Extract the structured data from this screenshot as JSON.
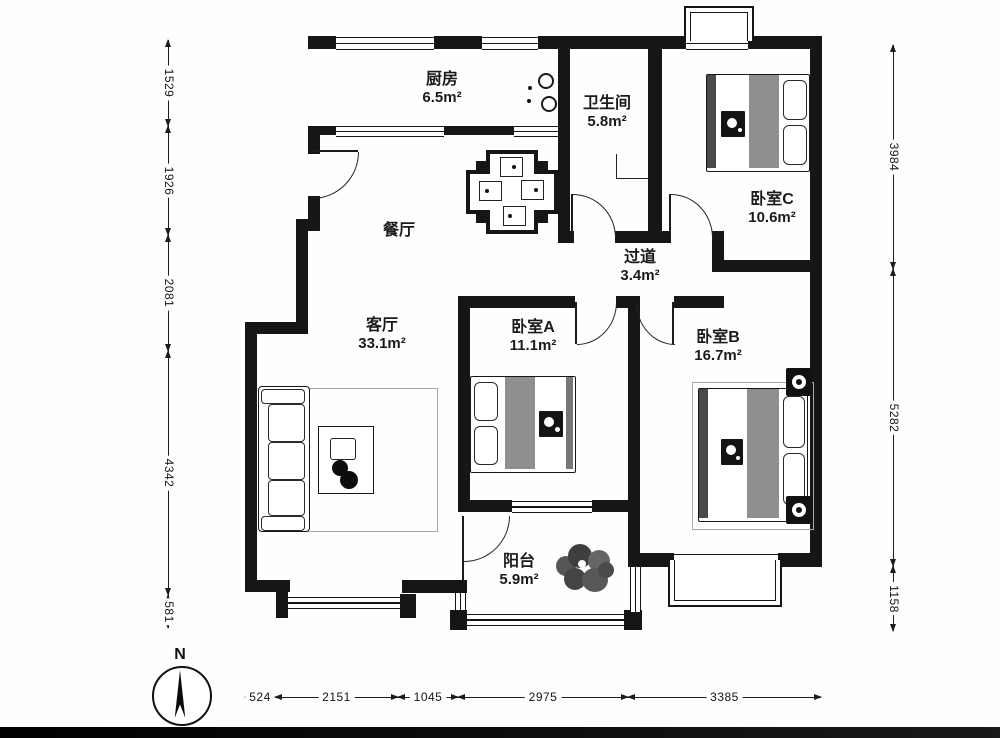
{
  "compass": {
    "north_label": "N"
  },
  "rooms": {
    "kitchen": {
      "name": "厨房",
      "area": "6.5m²"
    },
    "bathroom": {
      "name": "卫生间",
      "area": "5.8m²"
    },
    "bedroom_c": {
      "name": "卧室C",
      "area": "10.6m²"
    },
    "dining": {
      "name": "餐厅"
    },
    "hallway": {
      "name": "过道",
      "area": "3.4m²"
    },
    "living": {
      "name": "客厅",
      "area": "33.1m²"
    },
    "bedroom_a": {
      "name": "卧室A",
      "area": "11.1m²"
    },
    "bedroom_b": {
      "name": "卧室B",
      "area": "16.7m²"
    },
    "balcony": {
      "name": "阳台",
      "area": "5.9m²"
    }
  },
  "dimensions": {
    "left": [
      "1529",
      "1926",
      "2081",
      "4342",
      "581"
    ],
    "right": [
      "3984",
      "5282",
      "1158"
    ],
    "bottom": [
      "524",
      "2151",
      "1045",
      "2975",
      "3385"
    ]
  },
  "colors": {
    "wall": "#161616",
    "bed_stripe": "#8f8f8f",
    "furniture_dark": "#4a4a4a"
  }
}
